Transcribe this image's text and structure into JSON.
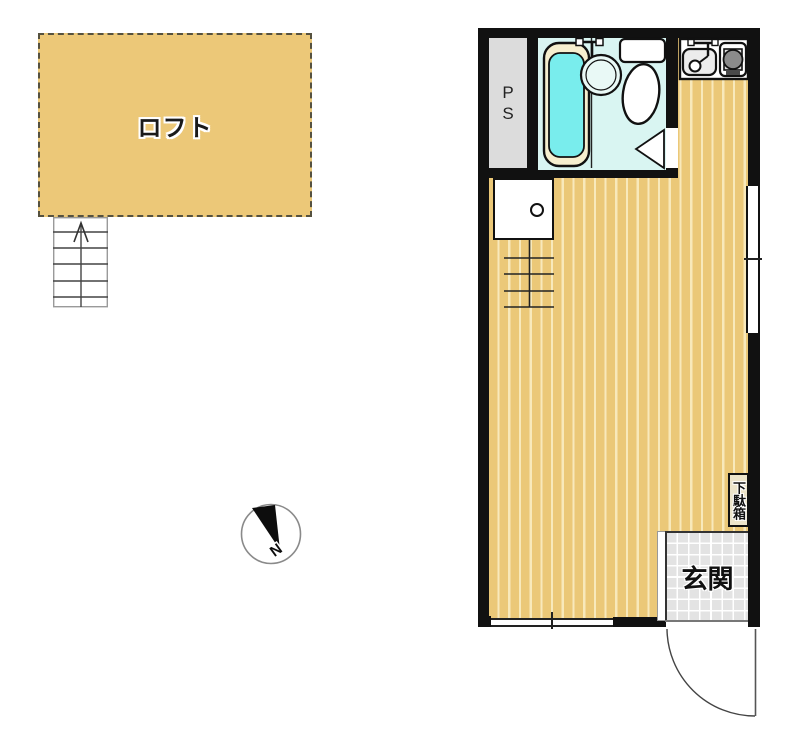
{
  "loft": {
    "label": "ロフト"
  },
  "pipe_space": {
    "line1": "P",
    "line2": "S"
  },
  "shoe_cabinet": {
    "label": "下駄箱"
  },
  "entrance": {
    "label": "玄関"
  },
  "compass": {
    "north_label": "N"
  },
  "colors": {
    "wall": "#111111",
    "floor_tan": "#ebc878",
    "floor_stripe": "#f8e9bb",
    "loft_fill": "#ecc878",
    "loft_border": "#55513f",
    "bathroom_floor": "#d9f5f2",
    "bathtub_water": "#79eded",
    "bathtub_rim": "#f6efcf",
    "pipe_space_fill": "#dcdcdc",
    "entrance_tile": "#e3e3e3"
  }
}
